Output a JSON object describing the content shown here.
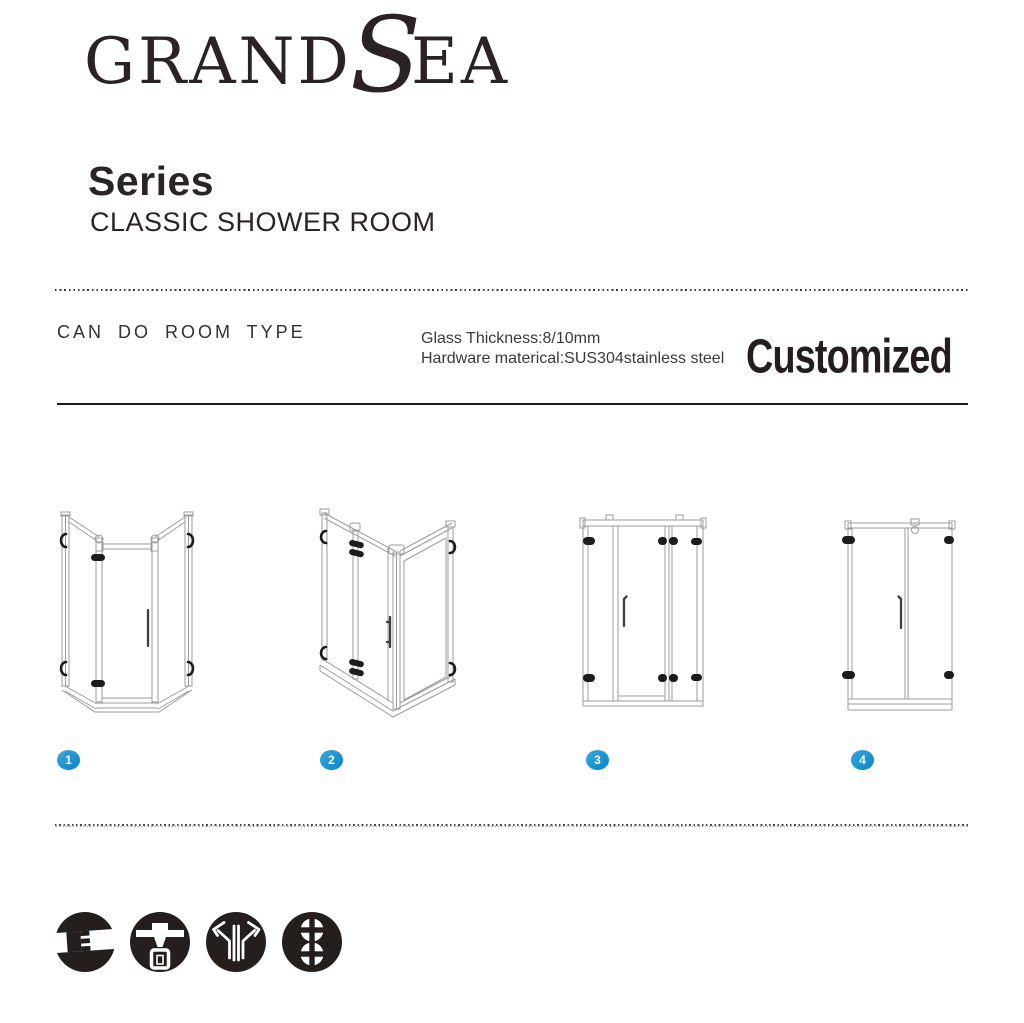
{
  "brand": {
    "grand": "GRAND",
    "s": "S",
    "ea": "EA"
  },
  "header": {
    "series": "Series",
    "subtitle": "CLASSIC SHOWER ROOM"
  },
  "specs": {
    "heading": "CAN DO ROOM TYPE",
    "glass": "Glass Thickness:8/10mm",
    "hardware": "Hardware materical:SUS304stainless steel",
    "customized": "Customized"
  },
  "room_types": [
    {
      "number": "1",
      "name": "neo-angle diamond shower enclosure"
    },
    {
      "number": "2",
      "name": "corner rectangular shower enclosure"
    },
    {
      "number": "3",
      "name": "inline hinged door with two fixed panels"
    },
    {
      "number": "4",
      "name": "hinged door with inline fixed panel"
    }
  ],
  "footer": {
    "icons": [
      {
        "name": "glass-joint-icon"
      },
      {
        "name": "glass-clamp-icon"
      },
      {
        "name": "hinge-support-icon"
      },
      {
        "name": "double-roller-icon"
      }
    ]
  },
  "colors": {
    "accent_blue": "#1a97d5",
    "line_gray": "#9b9b9b",
    "hardware_black": "#1c1c1c",
    "text_dark": "#272020"
  }
}
